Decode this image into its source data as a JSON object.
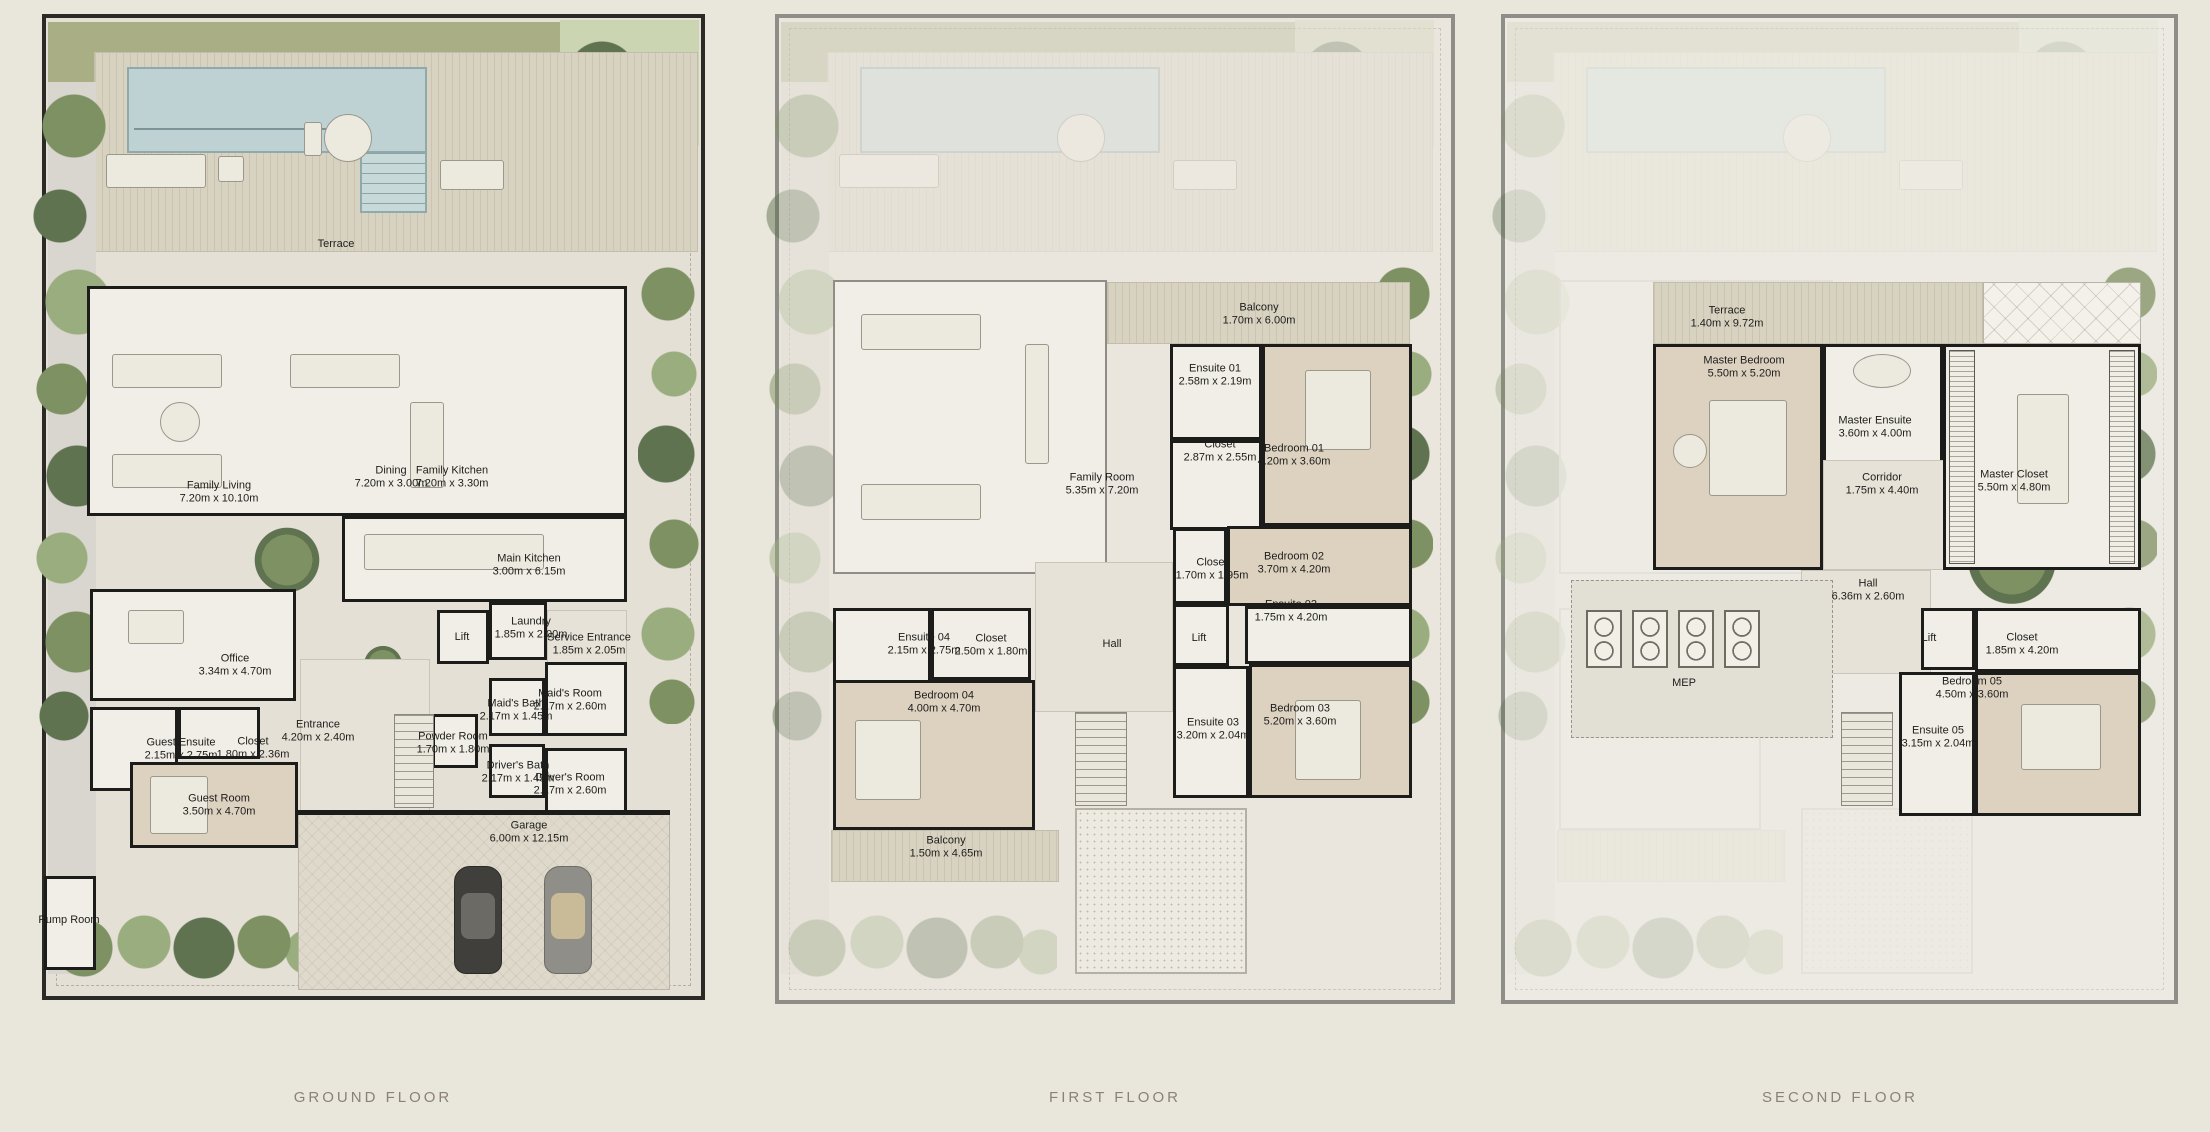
{
  "document": {
    "type": "villa-floor-plan-sheet",
    "background_color": "#e9e6dc",
    "colors": {
      "wall": "#1c1c1a",
      "pool": "#bed2d4",
      "grass": "#a9ae85",
      "tree": "#7d9162",
      "deck": "#d8d2c1",
      "title_text": "#8b8276"
    }
  },
  "floors": [
    {
      "id": "ground",
      "title": "GROUND FLOOR",
      "rooms": [
        {
          "name": "Terrace",
          "dims": "",
          "x": 294,
          "y": 230
        },
        {
          "name": "Family Living",
          "dims": "7.20m x 10.10m",
          "x": 177,
          "y": 478
        },
        {
          "name": "Dining",
          "dims": "7.20m x 3.00m",
          "x": 349,
          "y": 463
        },
        {
          "name": "Family Kitchen",
          "dims": "7.20m x 3.30m",
          "x": 410,
          "y": 463
        },
        {
          "name": "Main Kitchen",
          "dims": "3.00m x 6.15m",
          "x": 487,
          "y": 551
        },
        {
          "name": "Lift",
          "dims": "",
          "x": 420,
          "y": 623
        },
        {
          "name": "Laundry",
          "dims": "1.85m x 2.00m",
          "x": 489,
          "y": 614
        },
        {
          "name": "Service Entrance",
          "dims": "1.85m x 2.05m",
          "x": 547,
          "y": 630
        },
        {
          "name": "Office",
          "dims": "3.34m x 4.70m",
          "x": 193,
          "y": 651
        },
        {
          "name": "Maid's Bath",
          "dims": "2.17m x 1.45m",
          "x": 474,
          "y": 696
        },
        {
          "name": "Maid's Room",
          "dims": "2.17m x 2.60m",
          "x": 528,
          "y": 686
        },
        {
          "name": "Entrance",
          "dims": "4.20m x 2.40m",
          "x": 276,
          "y": 717
        },
        {
          "name": "Powder Room",
          "dims": "1.70m x 1.80m",
          "x": 411,
          "y": 729
        },
        {
          "name": "Guest Ensuite",
          "dims": "2.15m x 2.75m",
          "x": 139,
          "y": 735
        },
        {
          "name": "Closet",
          "dims": "1.80m x 2.36m",
          "x": 211,
          "y": 734
        },
        {
          "name": "Driver's Bath",
          "dims": "2.17m x 1.45m",
          "x": 476,
          "y": 758
        },
        {
          "name": "Driver's Room",
          "dims": "2.17m x 2.60m",
          "x": 528,
          "y": 770
        },
        {
          "name": "Guest Room",
          "dims": "3.50m x 4.70m",
          "x": 177,
          "y": 791
        },
        {
          "name": "Garage",
          "dims": "6.00m x 12.15m",
          "x": 487,
          "y": 818
        },
        {
          "name": "Pump Room",
          "dims": "",
          "x": 27,
          "y": 906
        }
      ]
    },
    {
      "id": "first",
      "title": "FIRST FLOOR",
      "rooms": [
        {
          "name": "Balcony",
          "dims": "1.70m x 6.00m",
          "x": 484,
          "y": 300
        },
        {
          "name": "Ensuite 01",
          "dims": "2.58m x 2.19m",
          "x": 440,
          "y": 361
        },
        {
          "name": "Closet",
          "dims": "2.87m x 2.55m",
          "x": 445,
          "y": 437
        },
        {
          "name": "Bedroom 01",
          "dims": "4.20m x 3.60m",
          "x": 519,
          "y": 441
        },
        {
          "name": "Family Room",
          "dims": "5.35m x 7.20m",
          "x": 327,
          "y": 470
        },
        {
          "name": "Closet",
          "dims": "1.70m x 1.95m",
          "x": 437,
          "y": 555
        },
        {
          "name": "Bedroom 02",
          "dims": "3.70m x 4.20m",
          "x": 519,
          "y": 549
        },
        {
          "name": "Ensuite 02",
          "dims": "1.75m x 4.20m",
          "x": 516,
          "y": 597
        },
        {
          "name": "Ensuite 04",
          "dims": "2.15m x 2.75m",
          "x": 149,
          "y": 630
        },
        {
          "name": "Closet",
          "dims": "2.50m x 1.80m",
          "x": 216,
          "y": 631
        },
        {
          "name": "Hall",
          "dims": "",
          "x": 337,
          "y": 630
        },
        {
          "name": "Lift",
          "dims": "",
          "x": 424,
          "y": 624
        },
        {
          "name": "Bedroom 04",
          "dims": "4.00m x 4.70m",
          "x": 169,
          "y": 688
        },
        {
          "name": "Ensuite 03",
          "dims": "3.20m x 2.04m",
          "x": 438,
          "y": 715
        },
        {
          "name": "Bedroom 03",
          "dims": "5.20m x 3.60m",
          "x": 525,
          "y": 701
        },
        {
          "name": "Balcony",
          "dims": "1.50m x 4.65m",
          "x": 171,
          "y": 833
        }
      ]
    },
    {
      "id": "second",
      "title": "SECOND FLOOR",
      "rooms": [
        {
          "name": "Terrace",
          "dims": "1.40m x 9.72m",
          "x": 226,
          "y": 303
        },
        {
          "name": "Master Bedroom",
          "dims": "5.50m x 5.20m",
          "x": 243,
          "y": 353
        },
        {
          "name": "Master Ensuite",
          "dims": "3.60m x 4.00m",
          "x": 374,
          "y": 413
        },
        {
          "name": "Corridor",
          "dims": "1.75m x 4.40m",
          "x": 381,
          "y": 470
        },
        {
          "name": "Master Closet",
          "dims": "5.50m x 4.80m",
          "x": 513,
          "y": 467
        },
        {
          "name": "Hall",
          "dims": "6.36m x 2.60m",
          "x": 367,
          "y": 576
        },
        {
          "name": "Lift",
          "dims": "",
          "x": 428,
          "y": 624
        },
        {
          "name": "Closet",
          "dims": "1.85m x 4.20m",
          "x": 521,
          "y": 630
        },
        {
          "name": "MEP",
          "dims": "",
          "x": 183,
          "y": 669
        },
        {
          "name": "Bedroom 05",
          "dims": "4.50m x 3.60m",
          "x": 471,
          "y": 674
        },
        {
          "name": "Ensuite 05",
          "dims": "3.15m x 2.04m",
          "x": 437,
          "y": 723
        }
      ]
    }
  ]
}
